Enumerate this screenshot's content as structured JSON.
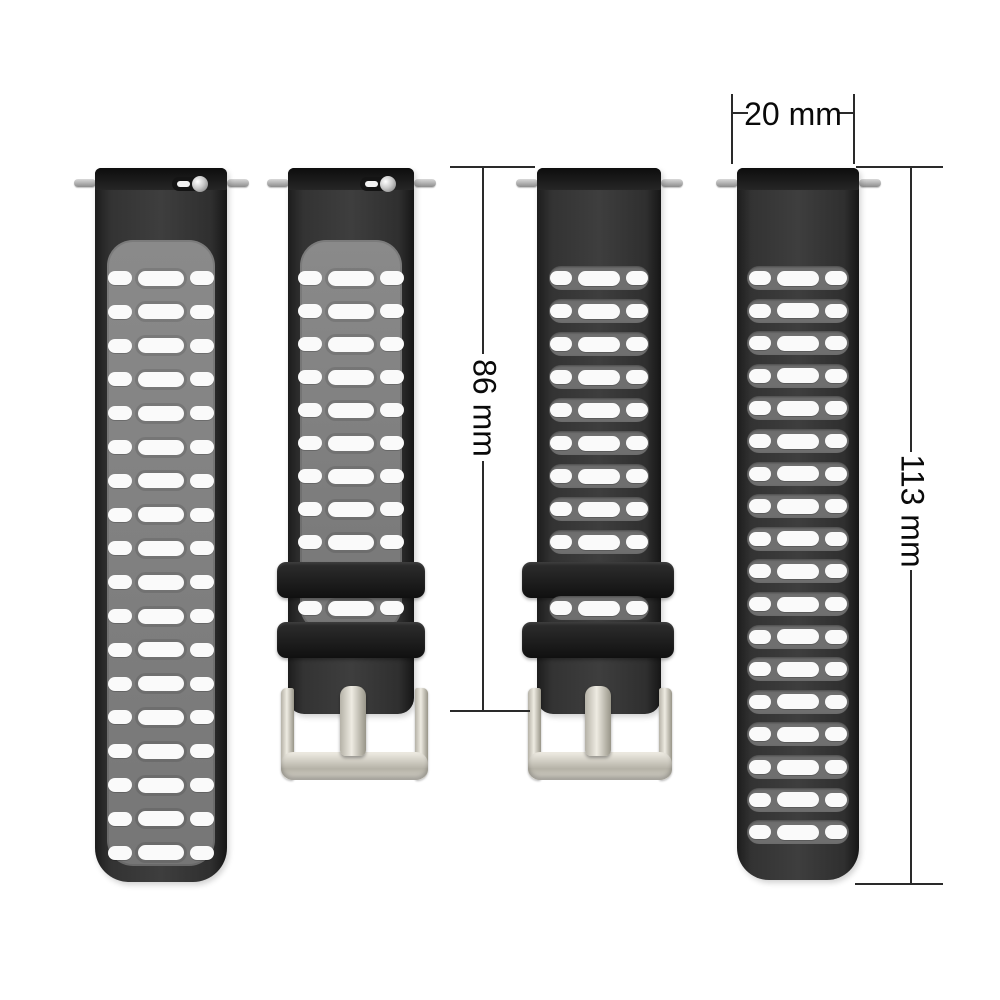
{
  "annotations": {
    "width_label": "20 mm",
    "buckle_strap_length_label": "86 mm",
    "holes_strap_length_label": "113 mm"
  },
  "straps": [
    {
      "name": "long-strap-gray-front",
      "variant": "front",
      "style": "long",
      "hole_rows": 18,
      "has_buckle": false,
      "quick_release": true
    },
    {
      "name": "buckle-strap-gray-front",
      "variant": "front",
      "style": "buckle",
      "hole_rows": 9,
      "has_buckle": true,
      "quick_release": true
    },
    {
      "name": "buckle-strap-black-back",
      "variant": "back",
      "style": "buckle",
      "hole_rows": 9,
      "has_buckle": true,
      "quick_release": false
    },
    {
      "name": "long-strap-black-back",
      "variant": "back",
      "style": "long",
      "hole_rows": 18,
      "has_buckle": false,
      "quick_release": false
    }
  ],
  "colors": {
    "background": "#ffffff",
    "strap_black": "#303030",
    "panel_gray": "#7f7f7f",
    "strip_gray": "#6f6f6f",
    "hole_white": "#fafafa",
    "keeper_black": "#1c1c1c",
    "buckle_silver": "#d9d6cd",
    "pin_silver": "#b5b5b5",
    "dimension_line": "#2a2a2a",
    "label_text": "#0a0a0a"
  }
}
